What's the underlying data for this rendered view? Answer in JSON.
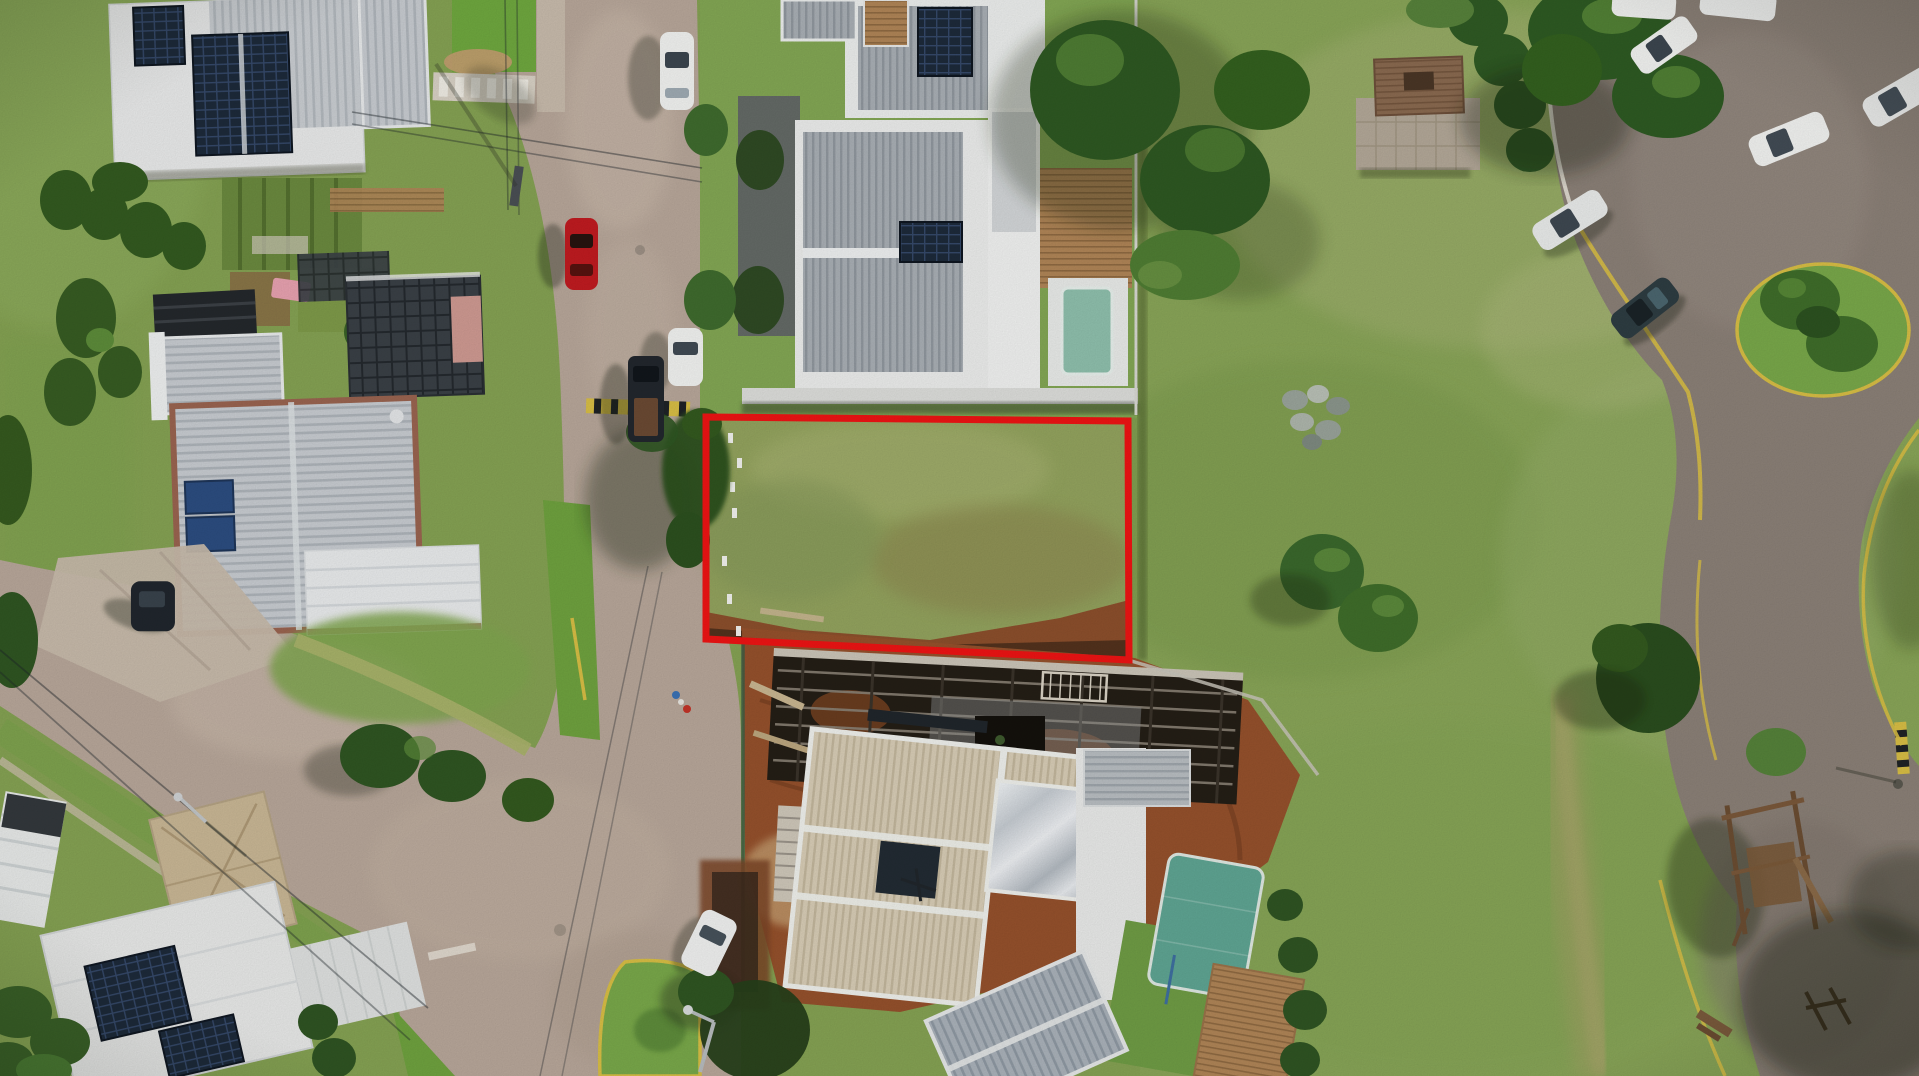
{
  "scene": {
    "description": "Aerial drone photograph of a gated residential neighborhood. A vacant grass lot between houses is outlined with a thick red boundary rectangle. Cobblestone streets with parked cars on the left, a construction site below the lot, modern houses with solar panels and pools, and a large mowed green field with palm trees, rocks and a wooden playground on the right, bordered by an asphalt road with white parked cars.",
    "annotation": {
      "type": "property-boundary-outline",
      "color": "#EE1414"
    },
    "palette": {
      "grass_base": "#85A253",
      "grass_bright": "#79A84A",
      "grass_pale": "#A9B577",
      "grass_dark": "#5E7C3C",
      "road_cobble": "#B8A79A",
      "road_cobble_light": "#CDBDAE",
      "road_asphalt": "#8B8077",
      "sidewalk": "#C8BBAC",
      "dirt_red": "#95512C",
      "dirt_dark": "#5F3118",
      "sand": "#C49D70",
      "roof_white": "#ECEDEC",
      "roof_silver": "#C8CCD1",
      "roof_gray": "#A9AFB5",
      "roof_cream": "#D8CDB6",
      "roof_tan_shingle": "#C9B795",
      "roof_glass": "#3A4046",
      "terracotta": "#9A6450",
      "solar_dark": "#1D2A3A",
      "solar_blue": "#2C4D80",
      "pool_pale": "#8FC0AD",
      "pool_teal": "#5FA593",
      "deck_wood": "#B08557",
      "tree_dark": "#2C5220",
      "palm_green": "#3F6D2A",
      "car_white": "#F2F3F1",
      "car_dark": "#22272D",
      "car_red": "#C01B20",
      "car_teal_dark": "#2E3D42",
      "curb_yellow": "#D8BE45",
      "curb_white": "#EAE6DC",
      "concrete": "#CFC9BC",
      "shadow": "#1B2412",
      "highlight": "#EE1414"
    }
  }
}
